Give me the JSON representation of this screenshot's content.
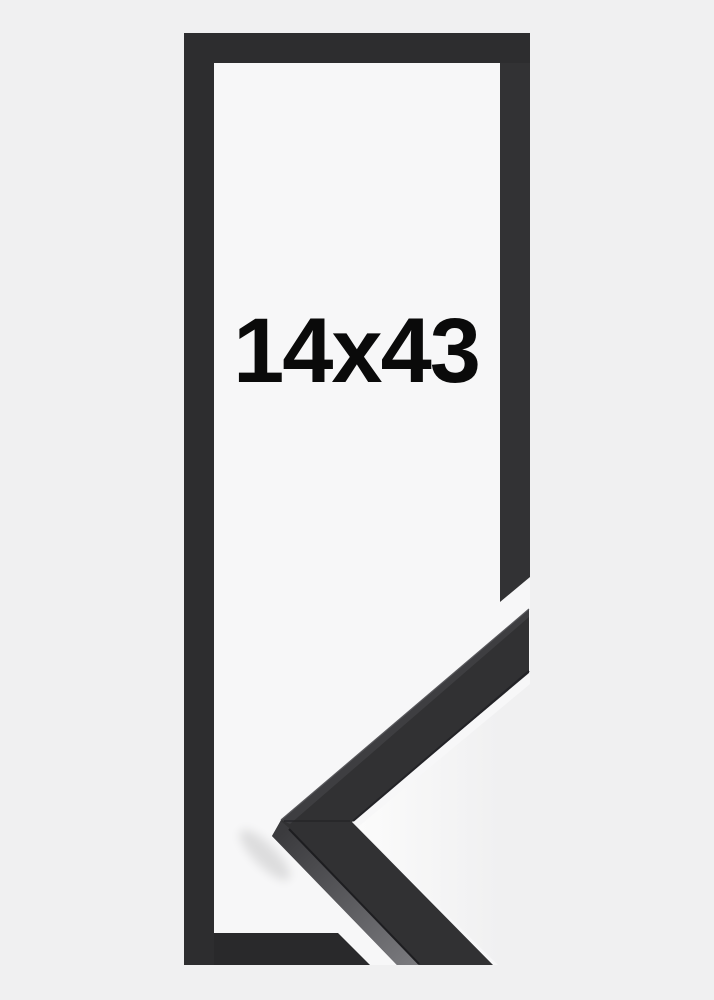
{
  "product": {
    "size_label": "14x43"
  },
  "colors": {
    "page_background": "#f0f0f1",
    "photo_background": "#f7f7f8",
    "frame_bar": "#2d2d2f",
    "frame_bar_right": "#323234",
    "frame_bar_bottom": "#29292b",
    "moulding_front": "#313133",
    "moulding_top_strip": "#3e3e41",
    "moulding_top_highlight": "#57575b",
    "moulding_side_near": "#3b3b3e",
    "moulding_side_far": "#7b7b7f",
    "moulding_arris": "#1d1d20",
    "moulding_inner_edge": "#232327",
    "miter_seam": "#232326",
    "wedge_near": "#fbfbfb",
    "wedge_far": "#f0f0f1",
    "corner_shadow": "#000000",
    "label_text": "#0a0a0a"
  }
}
